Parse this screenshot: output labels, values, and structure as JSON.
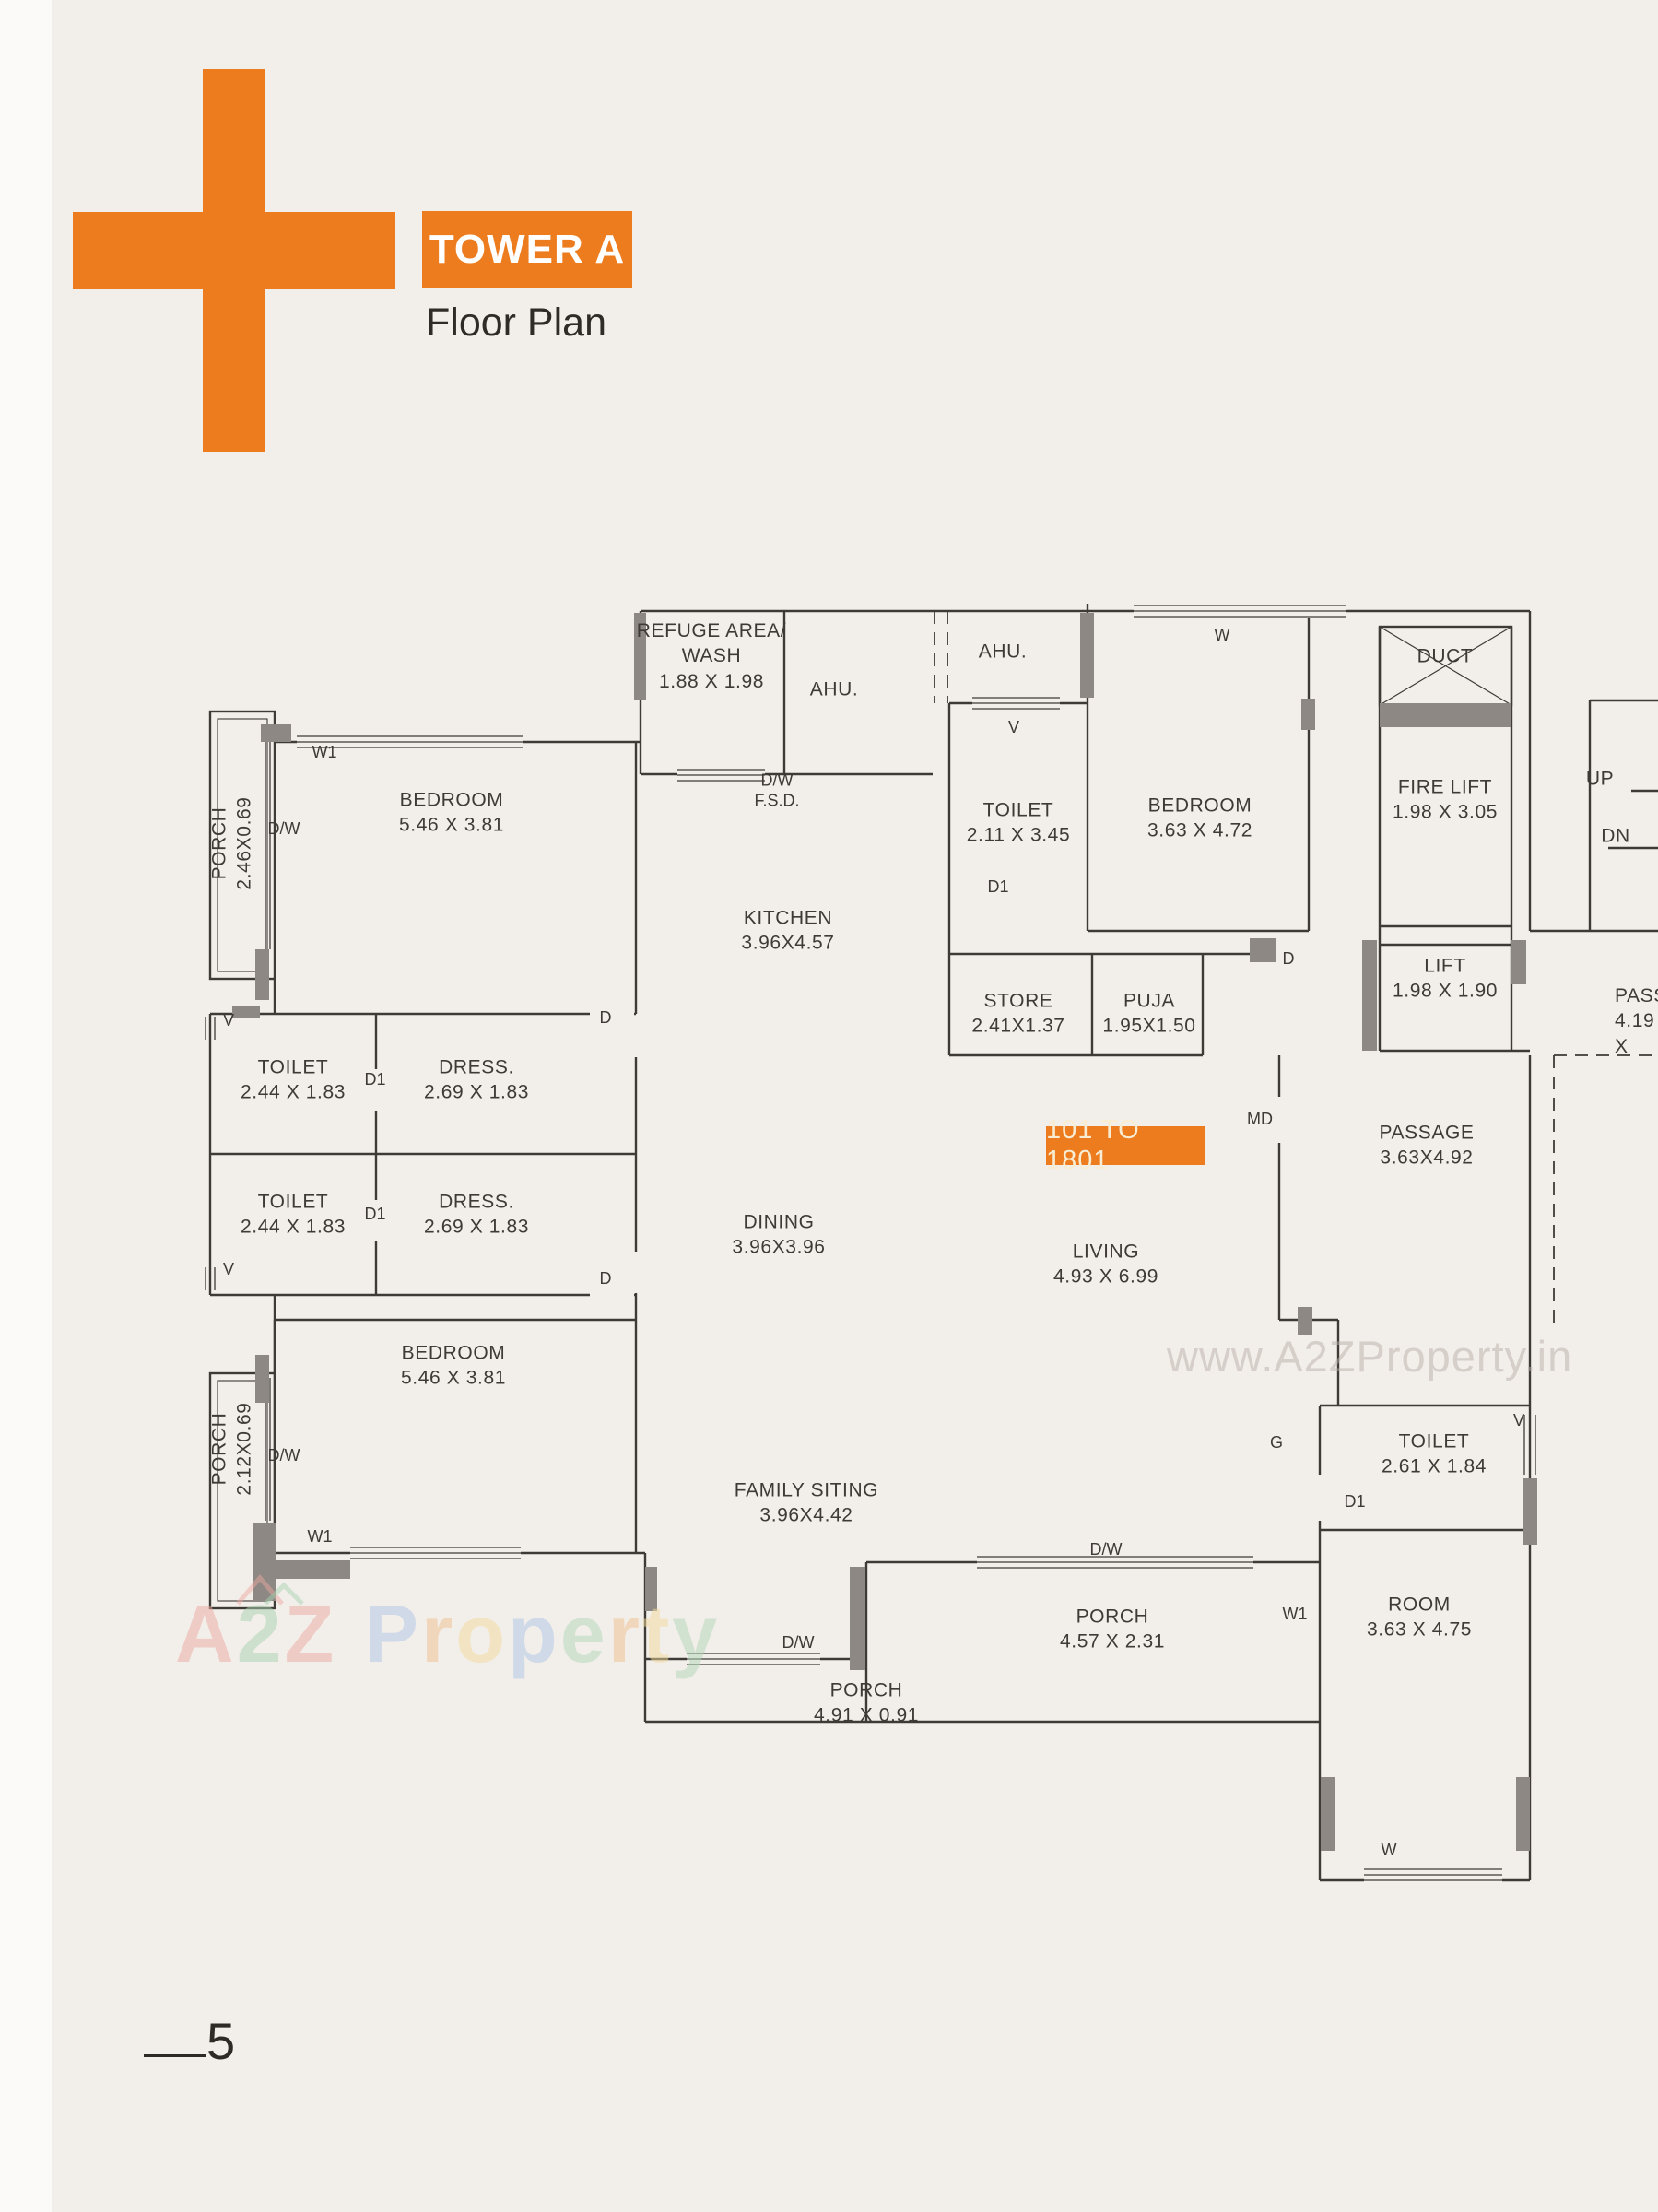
{
  "header": {
    "badge": "TOWER A",
    "subtitle": "Floor Plan"
  },
  "unit_range": "101 TO 1801",
  "watermark_url": "www.A2ZProperty.in",
  "brand": {
    "letters": [
      {
        "ch": "A",
        "style": "color:#eda9a2"
      },
      {
        "ch": "2",
        "style": "color:#a8d4b2"
      },
      {
        "ch": "Z",
        "style": "color:#eda9a2"
      },
      {
        "ch": "P",
        "style": "color:#adc6e8;margin-left:30px"
      },
      {
        "ch": "r",
        "style": "color:#f0c08e"
      },
      {
        "ch": "o",
        "style": "color:#f2dc9b"
      },
      {
        "ch": "p",
        "style": "color:#adc6e8"
      },
      {
        "ch": "e",
        "style": "color:#b2d8ba"
      },
      {
        "ch": "r",
        "style": "color:#f0c08e"
      },
      {
        "ch": "t",
        "style": "color:#f2dc9b"
      },
      {
        "ch": "y",
        "style": "color:#b2d8ba"
      }
    ]
  },
  "colors": {
    "accent": "#ec7c1e",
    "paper": "#f2eeea",
    "line": "#3e3a36",
    "column": "#8d8883"
  },
  "page": {
    "number": "5"
  },
  "rooms": [
    {
      "text": "REFUGE AREA/\nWASH\n1.88 X 1.98"
    },
    {
      "text": "AHU."
    },
    {
      "text": "AHU."
    },
    {
      "text": "DUCT"
    },
    {
      "text": "FIRE LIFT\n1.98 X 3.05"
    },
    {
      "text": "UP"
    },
    {
      "text": "DN"
    },
    {
      "text": "BEDROOM\n5.46 X 3.81"
    },
    {
      "text": "PORCH\n2.46X0.69"
    },
    {
      "text": "TOILET\n2.11 X 3.45"
    },
    {
      "text": "BEDROOM\n3.63 X 4.72"
    },
    {
      "text": "KITCHEN\n3.96X4.57"
    },
    {
      "text": "STORE\n2.41X1.37"
    },
    {
      "text": "PUJA\n1.95X1.50"
    },
    {
      "text": "LIFT\n1.98 X 1.90"
    },
    {
      "text": "PASS\n4.19 X"
    },
    {
      "text": "PASSAGE\n3.63X4.92"
    },
    {
      "text": "TOILET\n2.44 X 1.83"
    },
    {
      "text": "DRESS.\n2.69 X 1.83"
    },
    {
      "text": "TOILET\n2.44 X 1.83"
    },
    {
      "text": "DRESS.\n2.69 X 1.83"
    },
    {
      "text": "DINING\n3.96X3.96"
    },
    {
      "text": "LIVING\n4.93 X 6.99"
    },
    {
      "text": "BEDROOM\n5.46 X 3.81"
    },
    {
      "text": "PORCH\n2.12X0.69"
    },
    {
      "text": "FAMILY SITING\n3.96X4.42"
    },
    {
      "text": "TOILET\n2.61 X 1.84"
    },
    {
      "text": "ROOM\n3.63 X 4.75"
    },
    {
      "text": "PORCH\n4.57 X 2.31"
    },
    {
      "text": "PORCH\n4.91 X 0.91"
    }
  ],
  "markers": [
    {
      "text": "W1"
    },
    {
      "text": "D/W"
    },
    {
      "text": "D/W\nF.S.D."
    },
    {
      "text": "V"
    },
    {
      "text": "D1"
    },
    {
      "text": "D"
    },
    {
      "text": "W"
    },
    {
      "text": "MD"
    },
    {
      "text": "D"
    },
    {
      "text": "D1"
    },
    {
      "text": "V"
    },
    {
      "text": "V"
    },
    {
      "text": "D1"
    },
    {
      "text": "D"
    },
    {
      "text": "D/W"
    },
    {
      "text": "W1"
    },
    {
      "text": "D/W"
    },
    {
      "text": "D/W"
    },
    {
      "text": "W1"
    },
    {
      "text": "V"
    },
    {
      "text": "D1"
    },
    {
      "text": "G"
    },
    {
      "text": "W"
    }
  ]
}
